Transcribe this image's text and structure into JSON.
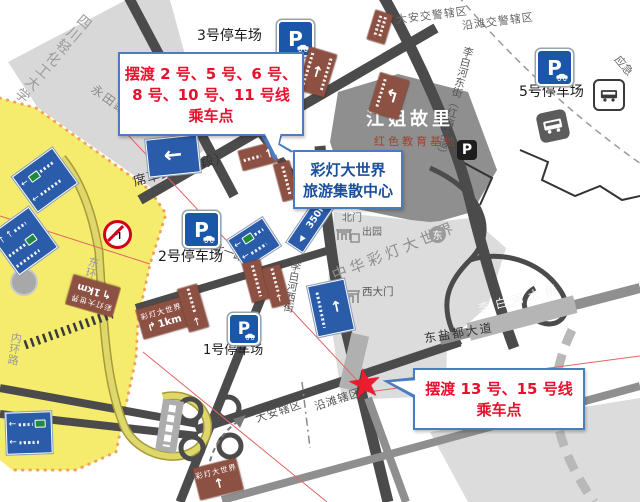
{
  "callouts": {
    "shuttle_north": {
      "lines": [
        "摆渡 2 号、5 号、6 号、",
        "8 号、10 号、11 号线",
        "乘车点"
      ]
    },
    "hub": {
      "lines": [
        "彩灯大世界",
        "旅游集散中心"
      ]
    },
    "shuttle_south": {
      "lines": [
        "摆渡 13 号、15 号线",
        "乘车点"
      ]
    }
  },
  "parking": {
    "p1": "1号停车场",
    "p2": "2号停车场",
    "p3": "3号停车场",
    "p5": "5号停车场",
    "p_letter": "P"
  },
  "areas": {
    "university": "四川轻化工大学",
    "jiangjie": "江姐故里",
    "jiangjie_sub": "红色教育基地",
    "park": "中华彩灯大世界"
  },
  "gates": {
    "north": "北门",
    "exit": "出园",
    "west": "西大门",
    "east": "东"
  },
  "roads": {
    "yongtian": "永田路",
    "xicao": "席草路（东段）",
    "libaihe_e": "李白河东街（红梅大道）",
    "libaihe_w": "李白河西街",
    "beiyi": "北一路",
    "dongyandu": "东盐都大道",
    "bridge": "李白河大桥",
    "neihuan": "内环路",
    "donghuan": "东环路"
  },
  "districts": {
    "daan_n": "大安交警辖区",
    "yantan_n": "沿滩交警辖区",
    "daan_s": "大安辖区",
    "yantan_s": "沿滩辖区"
  },
  "labels": {
    "m350": "350m",
    "km1": "1km",
    "lantern": "彩灯大世界",
    "emergency": "应急"
  },
  "icons": {
    "left_arrow": "←",
    "up_arrow": "↑",
    "left_tri": "◀",
    "uturn_left": "↰",
    "turn_right_up": "↱",
    "star": "★"
  },
  "colors": {
    "callout_border": "#4a7cc0",
    "shuttle_text_red": "#e8112d",
    "hub_text_blue": "#1a4f9c",
    "parking_sign_blue": "#1b57a8",
    "guide_sign_blue": "#2a5caa",
    "tourist_sign_brown": "#8d5144",
    "district_yellow": "#f5ec6e",
    "building_gray": "#8f8f8f",
    "star_red": "#ed1b2e"
  }
}
